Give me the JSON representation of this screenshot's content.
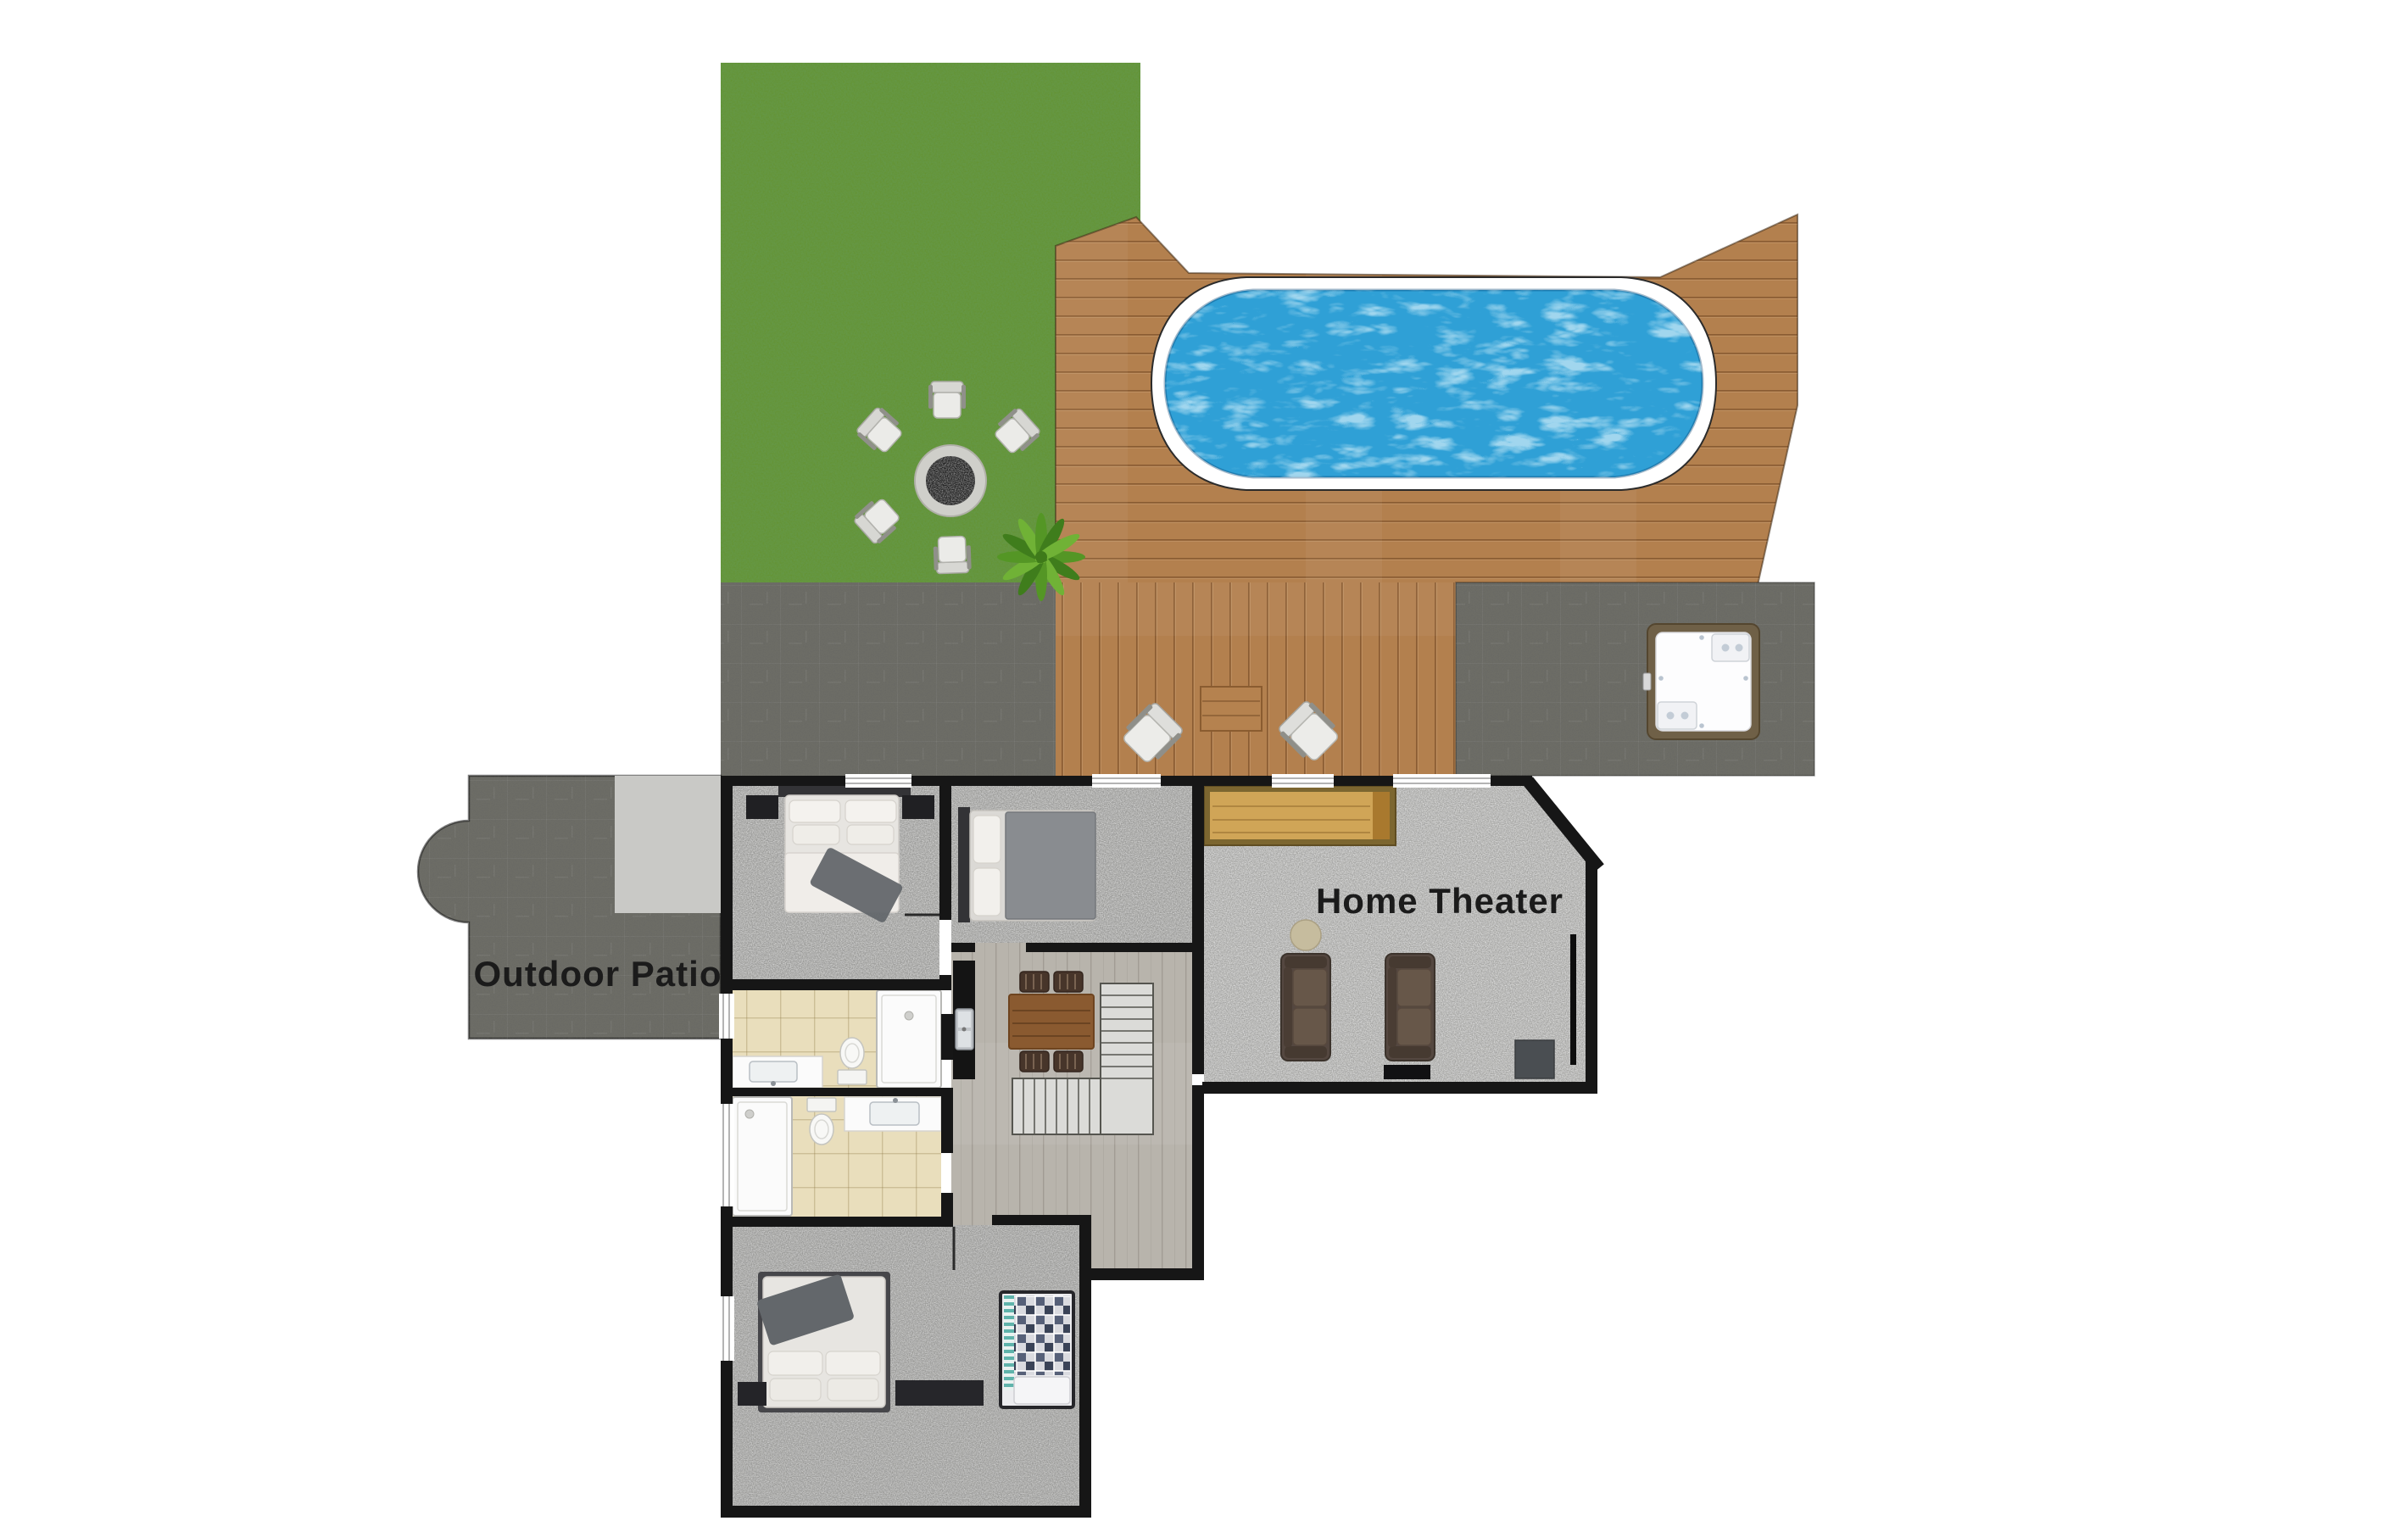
{
  "page": {
    "kind": "floor-plan-render",
    "background": "#ffffff"
  },
  "labels": {
    "home_theater": "Home Theater",
    "outdoor_patio": "Outdoor Patio"
  },
  "colors": {
    "wall": "#161616",
    "grass": "#649334",
    "grass_speckle": "#2e5a14",
    "deck_wood": "#b3804e",
    "deck_line": "#8a5c30",
    "patio_concrete": "#6d6d66",
    "patio_step": "#c9c9c6",
    "pool_water": "#2fa0d6",
    "pool_coping": "#ffffff",
    "carpet_bedroom": "#9a9a98",
    "carpet_theater": "#a5a5a3",
    "hall_wood": "#b8b4ac",
    "bath_tile": "#e9debc",
    "label_text": "#1b1b1b",
    "sofa_brown": "#544740",
    "sofa_cushion": "#675749",
    "dining_wood": "#8a5a30",
    "chair_dark": "#47352a",
    "console_wood": "#d0a557",
    "console_frame": "#7c6630",
    "hot_tub_frame": "#6f6047",
    "fixture_white": "#fbfbfb",
    "stairs_fill": "#dbdbd8",
    "bed_linen": "#e7e5e1",
    "bed_gray_duvet": "#898c90",
    "throw_gray": "#63676b",
    "furniture_black": "#202023",
    "plant_green": "#549625",
    "fire_coals": "#1c1c1c",
    "fire_ring": "#cfcfca",
    "tv_black": "#0d0d0d"
  },
  "features": [
    "grass lawn",
    "fire pit with stone ring",
    "five outdoor lounge chairs around fire pit",
    "green plant",
    "roman-style swimming pool with white coping",
    "angled wooden pool deck",
    "two diamond lounge chairs with side table on deck",
    "concrete patio strips",
    "hot tub with wood surround",
    "outdoor patio with rounded bump-out and light step pad",
    "bedroom top-left with double bed and nightstands",
    "bedroom middle with double bed",
    "home theater with wood console, two brown sofas, round side table, wall TV and media cabinet",
    "kitchen counter with stainless sink",
    "dining table with four chairs",
    "L-shaped staircase with landing",
    "bathroom with shower, toilet and vanity (upper)",
    "bathroom with shower, toilet and vanity (lower)",
    "bedroom bottom with double bed, dresser and bunk bed with plaid quilt"
  ]
}
